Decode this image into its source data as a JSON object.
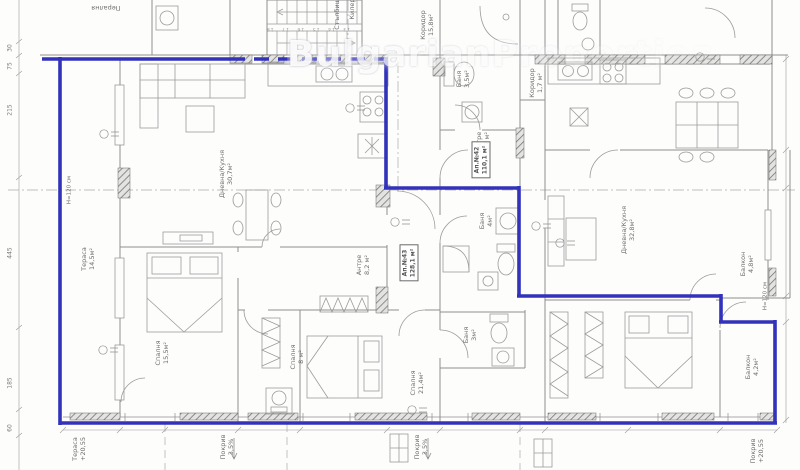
{
  "watermark": {
    "text": "BulgarianProperties"
  },
  "colors": {
    "outline_blue": "#3232ba",
    "line_gray": "#8e8e8e"
  },
  "rooms": [
    {
      "name": "Пералня",
      "area": ""
    },
    {
      "name": "Стълбище",
      "area": ""
    },
    {
      "name": "Килер",
      "area": ""
    },
    {
      "name": "Коридор",
      "area": "15,8м²"
    },
    {
      "name": "Баня",
      "area": "3,5м²"
    },
    {
      "name": "Коридор",
      "area": "1,7 м²"
    },
    {
      "name": "Антре",
      "area": "3,7 м²"
    },
    {
      "name": "Дневна/Кухня",
      "area": "30,7м²"
    },
    {
      "name": "Тераса",
      "area": "14,5м²"
    },
    {
      "name": "Антре",
      "area": "8,2 м²"
    },
    {
      "name": "Баня",
      "area": "4м²"
    },
    {
      "name": "Дневна/Кухня",
      "area": "32,8м²"
    },
    {
      "name": "Балкон",
      "area": "4,8м²"
    },
    {
      "name": "Спалня",
      "area": "15,5м²"
    },
    {
      "name": "Спалня",
      "area": "8 м²"
    },
    {
      "name": "Спалня",
      "area": "21,4м²"
    },
    {
      "name": "Баня",
      "area": "3м²"
    },
    {
      "name": "Балкон",
      "area": "4,2м²"
    }
  ],
  "apartments": [
    {
      "id": "Ап.№42",
      "area": "110,1 м²"
    },
    {
      "id": "Ап.№43",
      "area": "128,1 м²"
    }
  ],
  "annotations": [
    {
      "name": "Тераса",
      "value": "+20,55"
    },
    {
      "name": "Покрив",
      "value": "3,5%"
    },
    {
      "name": "Покрив",
      "value": "3,5%"
    },
    {
      "name": "Покрив",
      "value": "+20,55"
    }
  ],
  "notes": {
    "parapet": "Н=120 см",
    "stair_steps": "13 14 15 16 17 18"
  },
  "dimensions": {
    "left": [
      "30",
      "75",
      "215",
      "445",
      "185",
      "60"
    ]
  }
}
